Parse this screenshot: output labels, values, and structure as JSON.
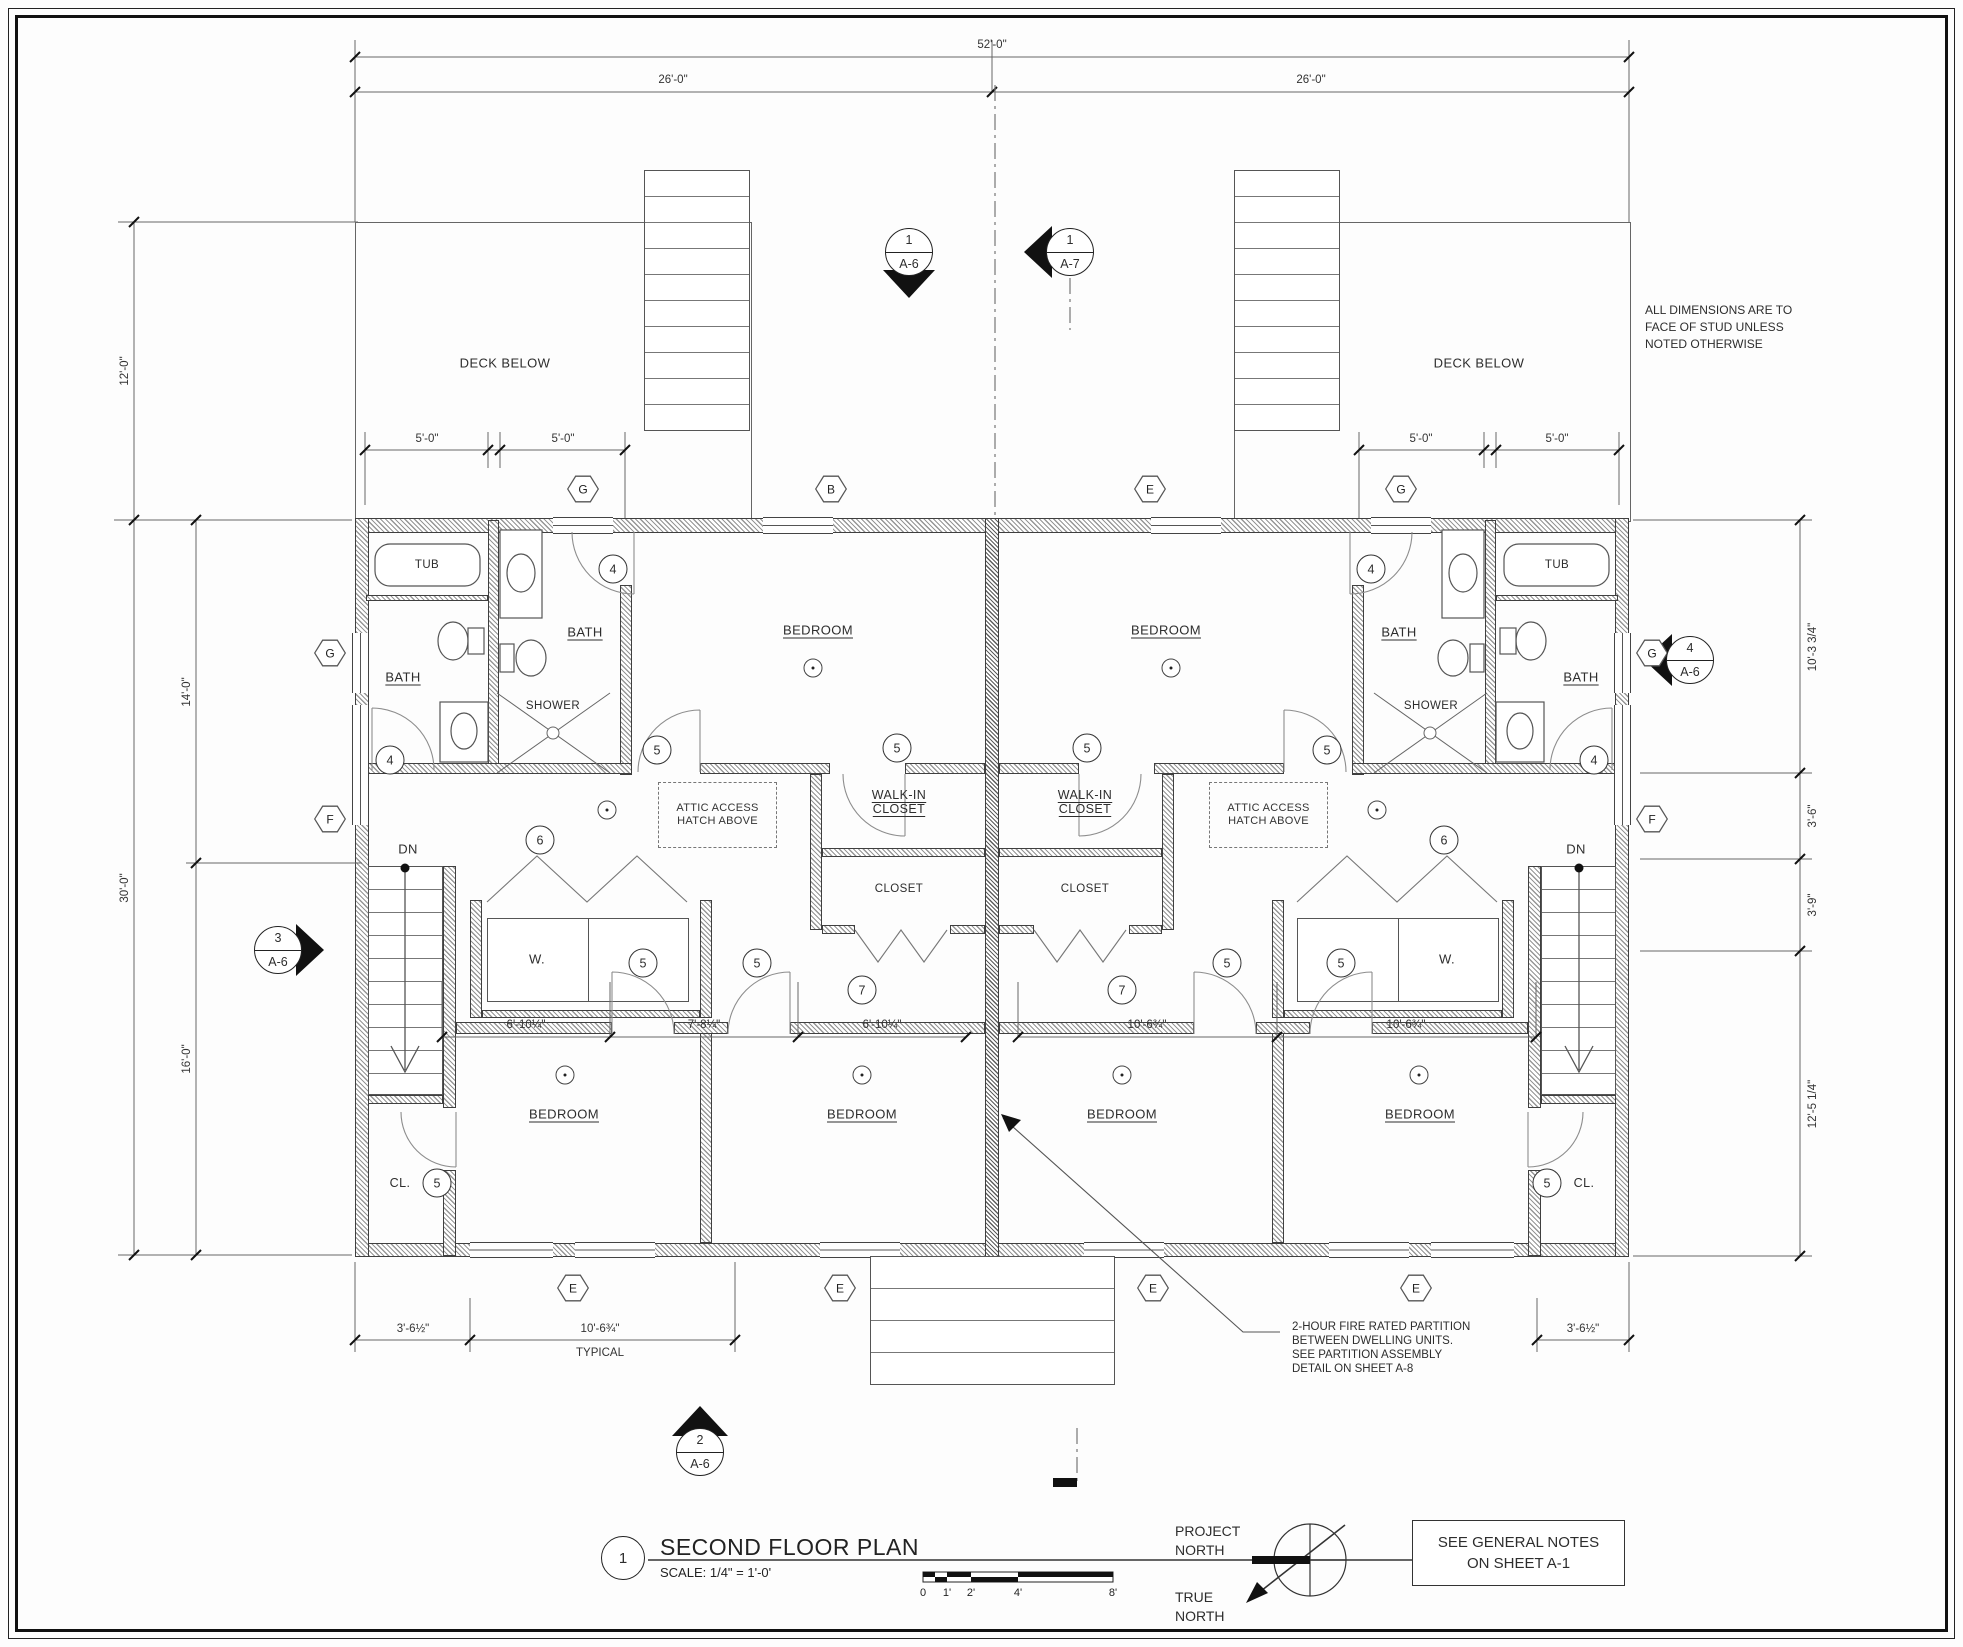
{
  "sheet": {
    "number": "1",
    "title": "SECOND FLOOR PLAN",
    "scale": "SCALE: 1/4\" = 1'-0'"
  },
  "notes": {
    "stud": "ALL DIMENSIONS ARE TO\nFACE OF STUD UNLESS\nNOTED OTHERWISE",
    "fire": "2-HOUR FIRE RATED PARTITION\nBETWEEN DWELLING UNITS.\nSEE PARTITION ASSEMBLY\nDETAIL ON SHEET A-8",
    "general": "SEE GENERAL NOTES\nON SHEET A-1",
    "project_north": "PROJECT\nNORTH",
    "true_north": "TRUE\nNORTH"
  },
  "rooms": {
    "bedroom": "BEDROOM",
    "bath": "BATH",
    "shower": "SHOWER",
    "tub": "TUB",
    "wic": "WALK-IN\nCLOSET",
    "closet": "CLOSET",
    "cl": "CL.",
    "washer": "W.",
    "dryer": "D.",
    "deck": "DECK BELOW",
    "dn": "DN",
    "attic": "ATTIC ACCESS\nHATCH ABOVE"
  },
  "dims": {
    "overall": "52'-0\"",
    "half": "26'-0\"",
    "deck_depth": "12'-0\"",
    "main_depth": "30'-0\"",
    "upper": "14'-0\"",
    "lower": "16'-0\"",
    "five": "5'-0\"",
    "right1": "10'-3 3/4\"",
    "right2": "3'-6\"",
    "right3": "3'-9\"",
    "right4": "12'-5 1/4\"",
    "bed_a": "6'-10¼\"",
    "bed_b": "7'-8¼\"",
    "bed_c": "10'-6¾\"",
    "corner": "3'-6½\"",
    "typical": "TYPICAL"
  },
  "markers": {
    "k4": "4",
    "k5": "5",
    "k6": "6",
    "k7": "7",
    "hex_g": "G",
    "hex_b": "B",
    "hex_e": "E",
    "hex_f": "F",
    "s1a6": {
      "n": "1",
      "s": "A-6"
    },
    "s1a7": {
      "n": "1",
      "s": "A-7"
    },
    "s2a6": {
      "n": "2",
      "s": "A-6"
    },
    "s3a6": {
      "n": "3",
      "s": "A-6"
    },
    "s4a6": {
      "n": "4",
      "s": "A-6"
    }
  },
  "scalebar": {
    "z": "0",
    "one": "1'",
    "two": "2'",
    "four": "4'",
    "eight": "8'"
  }
}
